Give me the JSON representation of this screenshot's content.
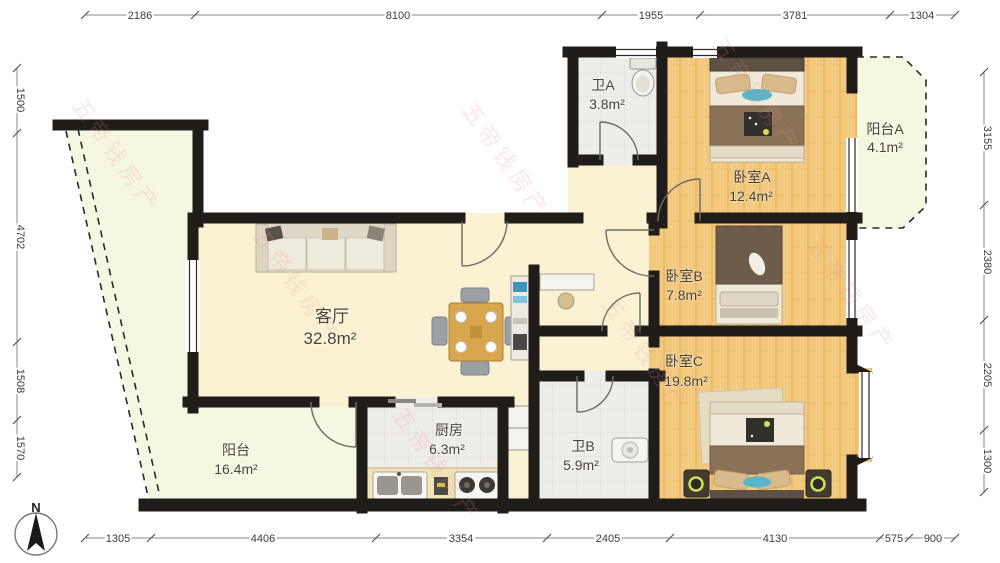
{
  "plan": {
    "type": "apartment-floor-plan",
    "rooms": {
      "living": {
        "name": "客厅",
        "area": "32.8m²"
      },
      "balcony_main": {
        "name": "阳台",
        "area": "16.4m²"
      },
      "kitchen": {
        "name": "厨房",
        "area": "6.3m²"
      },
      "bath_a": {
        "name": "卫A",
        "area": "3.8m²"
      },
      "bath_b": {
        "name": "卫B",
        "area": "5.9m²"
      },
      "bedroom_a": {
        "name": "卧室A",
        "area": "12.4m²"
      },
      "bedroom_b": {
        "name": "卧室B",
        "area": "7.8m²"
      },
      "bedroom_c": {
        "name": "卧室C",
        "area": "19.8m²"
      },
      "balcony_a": {
        "name": "阳台A",
        "area": "4.1m²"
      }
    },
    "dimensions": {
      "top": [
        "2186",
        "8100",
        "1955",
        "3781",
        "1304"
      ],
      "bottom": [
        "1305",
        "4406",
        "3354",
        "2405",
        "4130",
        "575",
        "900"
      ],
      "left": [
        "1500",
        "4702",
        "1508",
        "1570"
      ],
      "right": [
        "3155",
        "2380",
        "2205",
        "1300"
      ]
    },
    "compass": {
      "label": "N"
    },
    "watermark": {
      "text": "五帝钱房产"
    },
    "colors": {
      "wall": "#1f1c1a",
      "floor_main": "#fbf2d3",
      "floor_balcony": "#f6f7e0",
      "floor_tile": "#efedea",
      "accent_blue": "#55b7c8",
      "accent_lime": "#cde24e",
      "watermark_pink": "#e98b8b",
      "dim_text": "#3c3c3c"
    }
  }
}
